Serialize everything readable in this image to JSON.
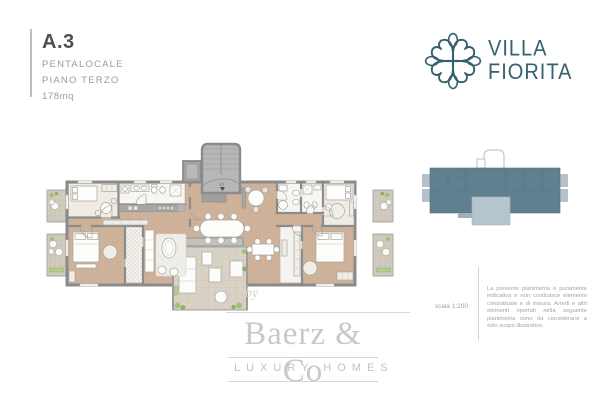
{
  "unit": {
    "label": "A.3",
    "type": "PENTALOCALE",
    "floor": "PIANO TERZO",
    "area": "178mq"
  },
  "brand": {
    "name_line1": "VILLA",
    "name_line2": "FIORITA",
    "color": "#35616d"
  },
  "floor_plan": {
    "entry_label": "A.3"
  },
  "legend": {
    "scale_label": "scala 1:200",
    "disclaimer": "La presente planimetria è puramente indicativa e non costituisce elemento contrattuale e di misura. Arredi e altri elementi riportati nella seguente planimetria sono da considerarsi a solo scopo illustrativo."
  },
  "watermark": {
    "by": "by",
    "name": "Baerz & Co",
    "tagline": "LUXURY HOMES"
  },
  "colors": {
    "wall_gray": "#8b8b8b",
    "wood_floor": "#cfb29a",
    "terrace_tile": "#d9d2c5",
    "plant_green": "#a4bf77",
    "keyplan_body": "#60808f",
    "keyplan_terrace": "#b5c5ce",
    "brand_teal": "#35616d",
    "watermark_gray": "#c9c9c9",
    "text_dark": "#4f4f4f",
    "text_gray": "#9b9b9b"
  }
}
